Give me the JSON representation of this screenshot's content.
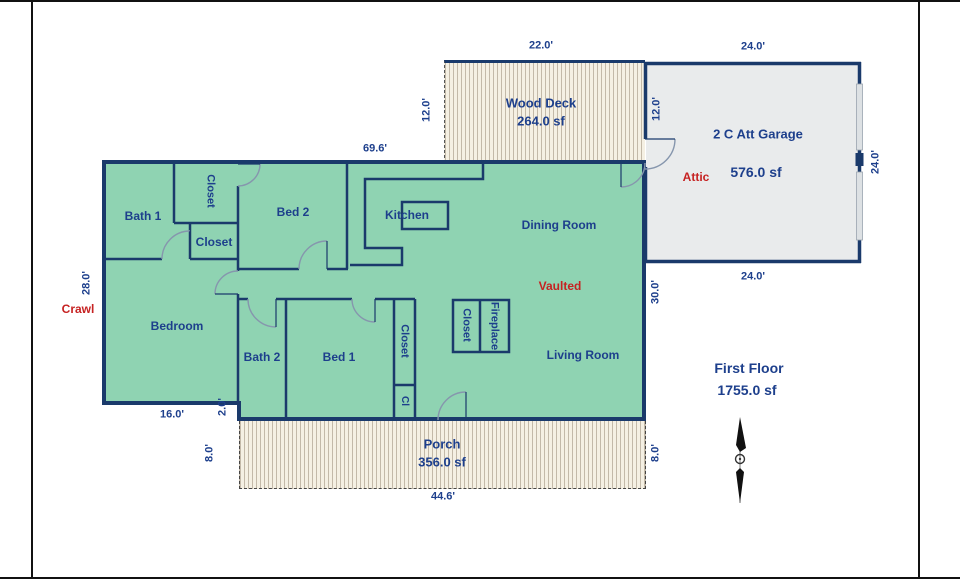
{
  "colors": {
    "wall": "#1a3a6b",
    "text": "#1d3f8c",
    "red": "#c62222",
    "floor": "#8fd3b2",
    "garage": "#e9ebec",
    "hatch_bg": "#f5f0e3",
    "hatch_line": "#c3b9a8",
    "arc": "#8696ad",
    "frame": "#111111"
  },
  "house": {
    "rooms": {
      "bath1": "Bath 1",
      "closet_top": "Closet",
      "closet_mid": "Closet",
      "bed2": "Bed 2",
      "kitchen": "Kitchen",
      "dining_room": "Dining Room",
      "bedroom": "Bedroom",
      "bath2": "Bath 2",
      "bed1": "Bed 1",
      "bed1_closet": "Closet",
      "bed1_closet_small": "Cl",
      "living_closet": "Closet",
      "fireplace": "Fireplace",
      "living_room": "Living Room"
    },
    "annotations": {
      "crawl": "Crawl",
      "vaulted": "Vaulted",
      "attic": "Attic"
    }
  },
  "deck": {
    "name": "Wood Deck",
    "area": "264.0 sf"
  },
  "garage": {
    "name": "2 C Att Garage",
    "area": "576.0 sf"
  },
  "porch": {
    "name": "Porch",
    "area": "356.0 sf"
  },
  "summary": {
    "floor": "First Floor",
    "area": "1755.0 sf"
  },
  "dimensions": {
    "deck_width": "22.0'",
    "deck_depth_left": "12.0'",
    "deck_depth_right": "12.0'",
    "garage_width_top": "24.0'",
    "garage_depth_right": "24.0'",
    "garage_width_bottom": "24.0'",
    "house_width_top": "69.6'",
    "house_depth_left": "28.0'",
    "house_depth_right": "30.0'",
    "bedroom_width": "16.0'",
    "step_depth": "2.0'",
    "porch_depth_left": "8.0'",
    "porch_depth_right": "8.0'",
    "porch_width": "44.6'"
  }
}
